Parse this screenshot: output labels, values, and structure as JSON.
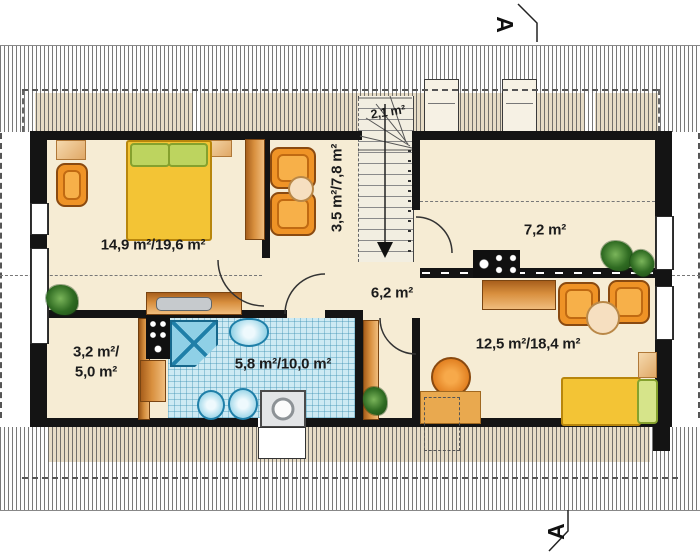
{
  "markers": {
    "section_top": "A",
    "section_bottom": "A"
  },
  "rooms": {
    "bedroom": {
      "label": "14,9 m²/19,6 m²"
    },
    "sitting": {
      "label": "3,5 m²/7,8 m²"
    },
    "stair_closet": {
      "label": "2,1 m²"
    },
    "kitchen": {
      "label": "7,2 m²"
    },
    "hall": {
      "label": "6,2 m²"
    },
    "storage": {
      "label_line1": "3,2 m²/",
      "label_line2": "5,0 m²"
    },
    "bathroom": {
      "label": "5,8 m²/10,0 m²"
    },
    "room2": {
      "label": "12,5 m²/18,4 m²"
    }
  },
  "icons": {
    "stair_direction": "down-arrow",
    "section_cut": "A-A"
  },
  "colors": {
    "wall": "#141414",
    "floor": "#f6ecd4",
    "roof_eaves_band": "#e7dcc6",
    "bathroom_tile": "#cdeaf3",
    "furniture_orange": "#ef9326",
    "bed_yellow": "#f3c435",
    "pillow_green": "#bdd45f",
    "wood_brown": "#c07828",
    "fixture_blue": "#7cc8e0",
    "plant_green": "#2f6b22"
  }
}
